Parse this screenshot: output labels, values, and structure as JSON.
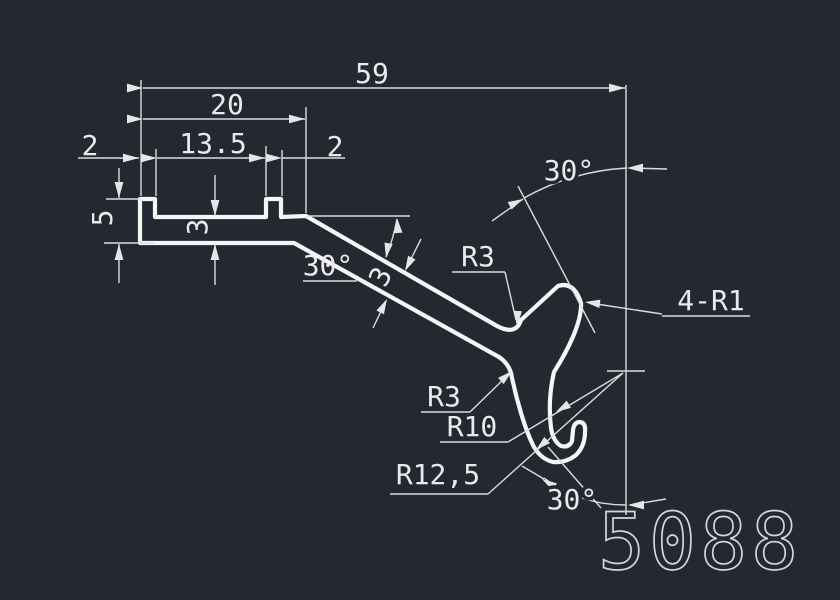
{
  "drawing": {
    "background_color": "#232831",
    "line_color": "#f5f5f5",
    "dim_color": "#eaeaea",
    "part_number": "5088"
  },
  "labels": {
    "dim_total_width": "59",
    "dim_top_width": "20",
    "dim_slot_width": "13.5",
    "dim_lip_left": "2",
    "dim_tab_right": "2",
    "dim_height_left": "5",
    "dim_floor_thickness": "3",
    "dim_wall_thickness": "3",
    "angle_slope": "30°",
    "angle_top": "30°",
    "angle_bottom": "30°",
    "radius_top_fillet": "R3",
    "radius_side_fillet": "R3",
    "radius_hook_inner": "R10",
    "radius_hook_outer": "R12,5",
    "radius_tips": "4-R1"
  }
}
